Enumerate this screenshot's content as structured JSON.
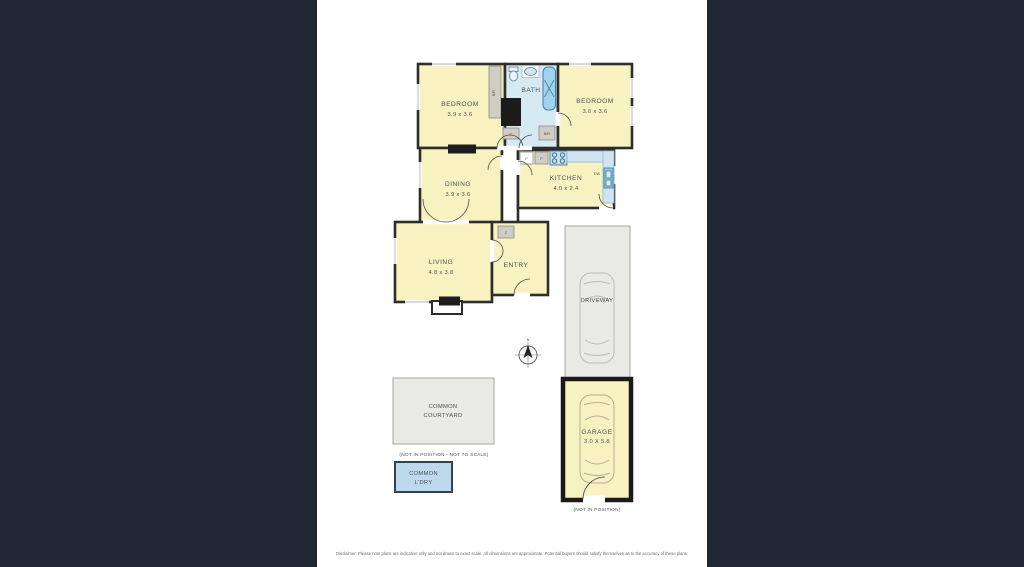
{
  "floorplan": {
    "rooms": {
      "bedroom1": {
        "label": "BEDROOM",
        "dims": "3.9 x 3.6"
      },
      "bath": {
        "label": "BATH"
      },
      "bedroom2": {
        "label": "BEDROOM",
        "dims": "3.0 x 3.6"
      },
      "dining": {
        "label": "DINING",
        "dims": "3.9 x 3.6"
      },
      "kitchen": {
        "label": "KITCHEN",
        "dims": "4.0 x 2.4"
      },
      "living": {
        "label": "LIVING",
        "dims": "4.8 x 3.8"
      },
      "entry": {
        "label": "ENTRY"
      }
    },
    "fixtures": {
      "robe_left": "B/R",
      "robe_right": "B/R",
      "cupboard_bath": "C",
      "cupboard_entry": "C",
      "fridge": "F",
      "pantry": "P",
      "dishwasher": "DW"
    },
    "outdoor": {
      "driveway": {
        "label": "DRIVEWAY"
      },
      "garage": {
        "label": "GARAGE",
        "dims": "3.0 X 5.8",
        "note": "(NOT IN POSITION)"
      },
      "courtyard": {
        "line1": "COMMON",
        "line2": "COURTYARD",
        "note": "(NOT IN POSITION - NOT TO SCALE)"
      },
      "laundry": {
        "line1": "COMMON",
        "line2": "L'DRY"
      }
    },
    "compass": {
      "north": "N"
    },
    "disclaimer": "Disclaimer: Please note plans are indicative only and not drawn to exact scale. All dimensions are approximate. Potential buyers should satisfy themselves as to the accuracy of these plans.",
    "colors": {
      "background": "#222734",
      "paper": "#ffffff",
      "room_fill": "#f8f2c1",
      "wet_area_fill": "#d6eaf4",
      "wall": "#2d2d2d",
      "fixture_blue": "#8fcbe9",
      "fixture_grey": "#d0cdc4",
      "outdoor_grey": "#e9e9e5",
      "laundry_blue": "#bdd9ee"
    }
  }
}
